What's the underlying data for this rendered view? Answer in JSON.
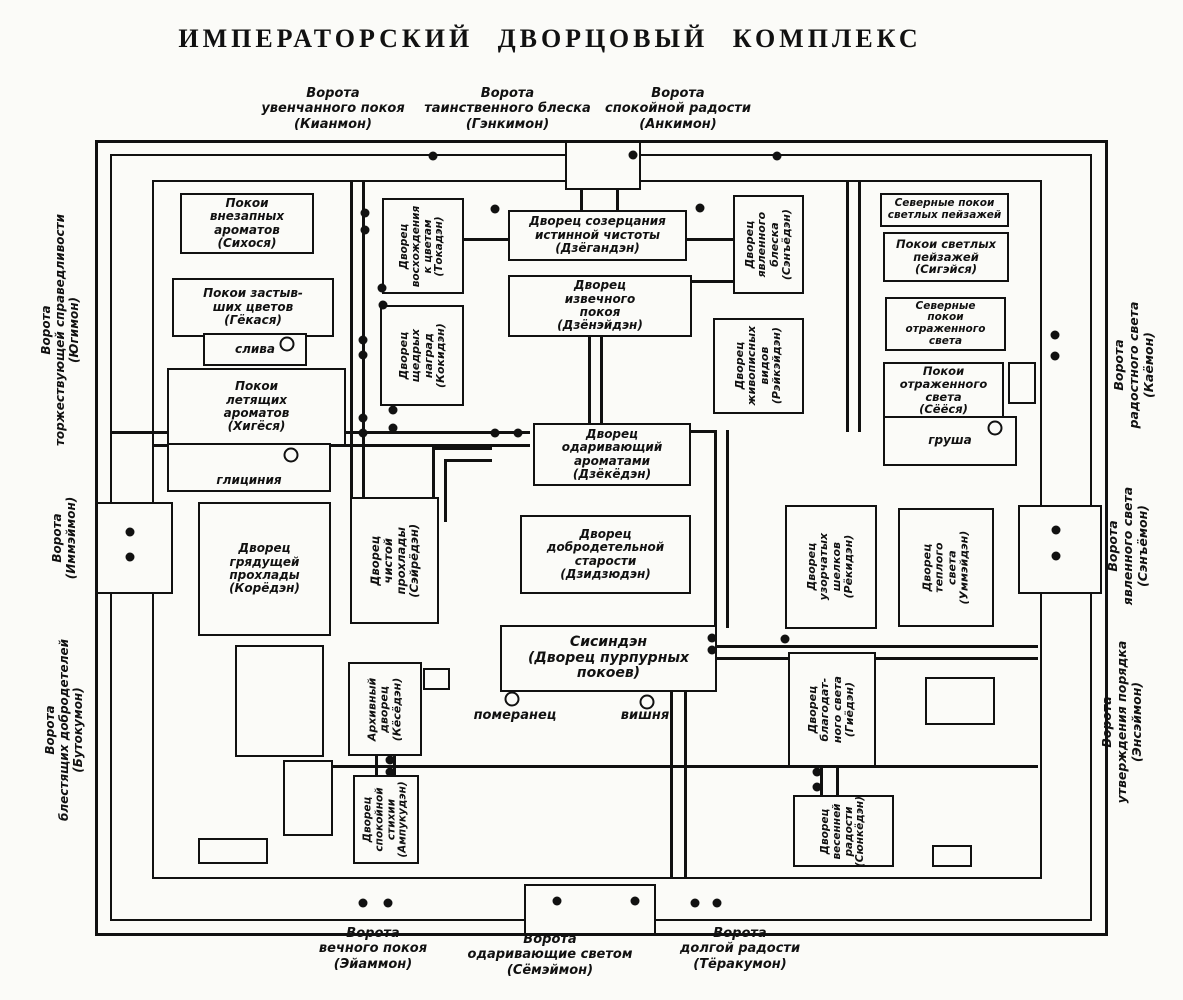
{
  "title": "ИМПЕРАТОРСКИЙ ДВОРЦОВЫЙ КОМПЛЕКС",
  "gates": {
    "top": [
      {
        "label": "Ворота\nувенчанного покоя\n(Кианмон)"
      },
      {
        "label": "Ворота\nтаинственного блеска\n(Гэнкимон)"
      },
      {
        "label": "Ворота\nспокойной радости\n(Анкимон)"
      }
    ],
    "bottom": [
      {
        "label": "Ворота\nвечного покоя\n(Эйаммон)"
      },
      {
        "label": "Ворота\nодаривающие светом\n(Сёмэймон)"
      },
      {
        "label": "Ворота\nдолгой радости\n(Тёракумон)"
      }
    ],
    "left": [
      {
        "label": "Ворота\nторжествующей справедливости\n(Югимон)"
      },
      {
        "label": "Ворота\n(Иммэймон)"
      },
      {
        "label": "Ворота\nблестящих добродетелей\n(Бутокумон)"
      }
    ],
    "right": [
      {
        "label": "Ворота\nрадостного света\n(Каёмон)"
      },
      {
        "label": "Ворота\nявленного света\n(Сэнъёмон)"
      },
      {
        "label": "Ворота\nутверждения порядка\n(Энсэймон)"
      }
    ]
  },
  "buildings": [
    {
      "label": "Покои\nвнезапных\nароматов\n(Сихося)"
    },
    {
      "label": "Покои застыв-\nших цветов\n(Гёкася)"
    },
    {
      "label": "Покои\nлетящих\nароматов\n(Хигёся)"
    },
    {
      "label": "Дворец\nвосхождения\nк цветам\n(Токадэн)"
    },
    {
      "label": "Дворец\nщедрых\nнаград\n(Кокидэн)"
    },
    {
      "label": "Дворец созерцания\nистинной чистоты\n(Дзёгандэн)"
    },
    {
      "label": "Дворец\nизвечного\nпокоя\n(Дзёнэйдэн)"
    },
    {
      "label": "Дворец\nявленного\nблеска\n(Сэнъёдэн)"
    },
    {
      "label": "Дворец\nживописных\nвидов\n(Рэйкэйдэн)"
    },
    {
      "label": "Северные покои\nсветлых пейзажей"
    },
    {
      "label": "Покои светлых\nпейзажей\n(Сигэйся)"
    },
    {
      "label": "Северные\nпокои\nотраженного\nсвета"
    },
    {
      "label": "Покои\nотраженного\nсвета\n(Сёёся)"
    },
    {
      "label": "Дворец\nодаривающий\nароматами\n(Дзёкёдэн)"
    },
    {
      "label": "Дворец\nдобродетельной\nстарости\n(Дзидзюдэн)"
    },
    {
      "label": "Сисиндэн\n(Дворец пурпурных\nпокоев)"
    },
    {
      "label": "Дворец\nгрядущей\nпрохлады\n(Корёдэн)"
    },
    {
      "label": "Дворец чистой\nпрохлады\n(Сэйрёдэн)"
    },
    {
      "label": "Дворец\nузорчатых\nшелков\n(Рёкидэн)"
    },
    {
      "label": "Дворец\nтеплого\nсвета\n(Уммэйдэн)"
    },
    {
      "label": "Архивный\nдворец\n(Кёсёдэн)"
    },
    {
      "label": "Дворец\nспокойной\nстихии\n(Ампукудэн)"
    },
    {
      "label": "Дворец\nблагодат-\nного света\n(Гиёдэн)"
    },
    {
      "label": "Дворец\nвесенней\nрадости\n(Сюнкёдэн)"
    }
  ],
  "trees": [
    {
      "label": "слива"
    },
    {
      "label": "глициния"
    },
    {
      "label": "груша"
    },
    {
      "label": "померанец"
    },
    {
      "label": "вишня"
    }
  ]
}
